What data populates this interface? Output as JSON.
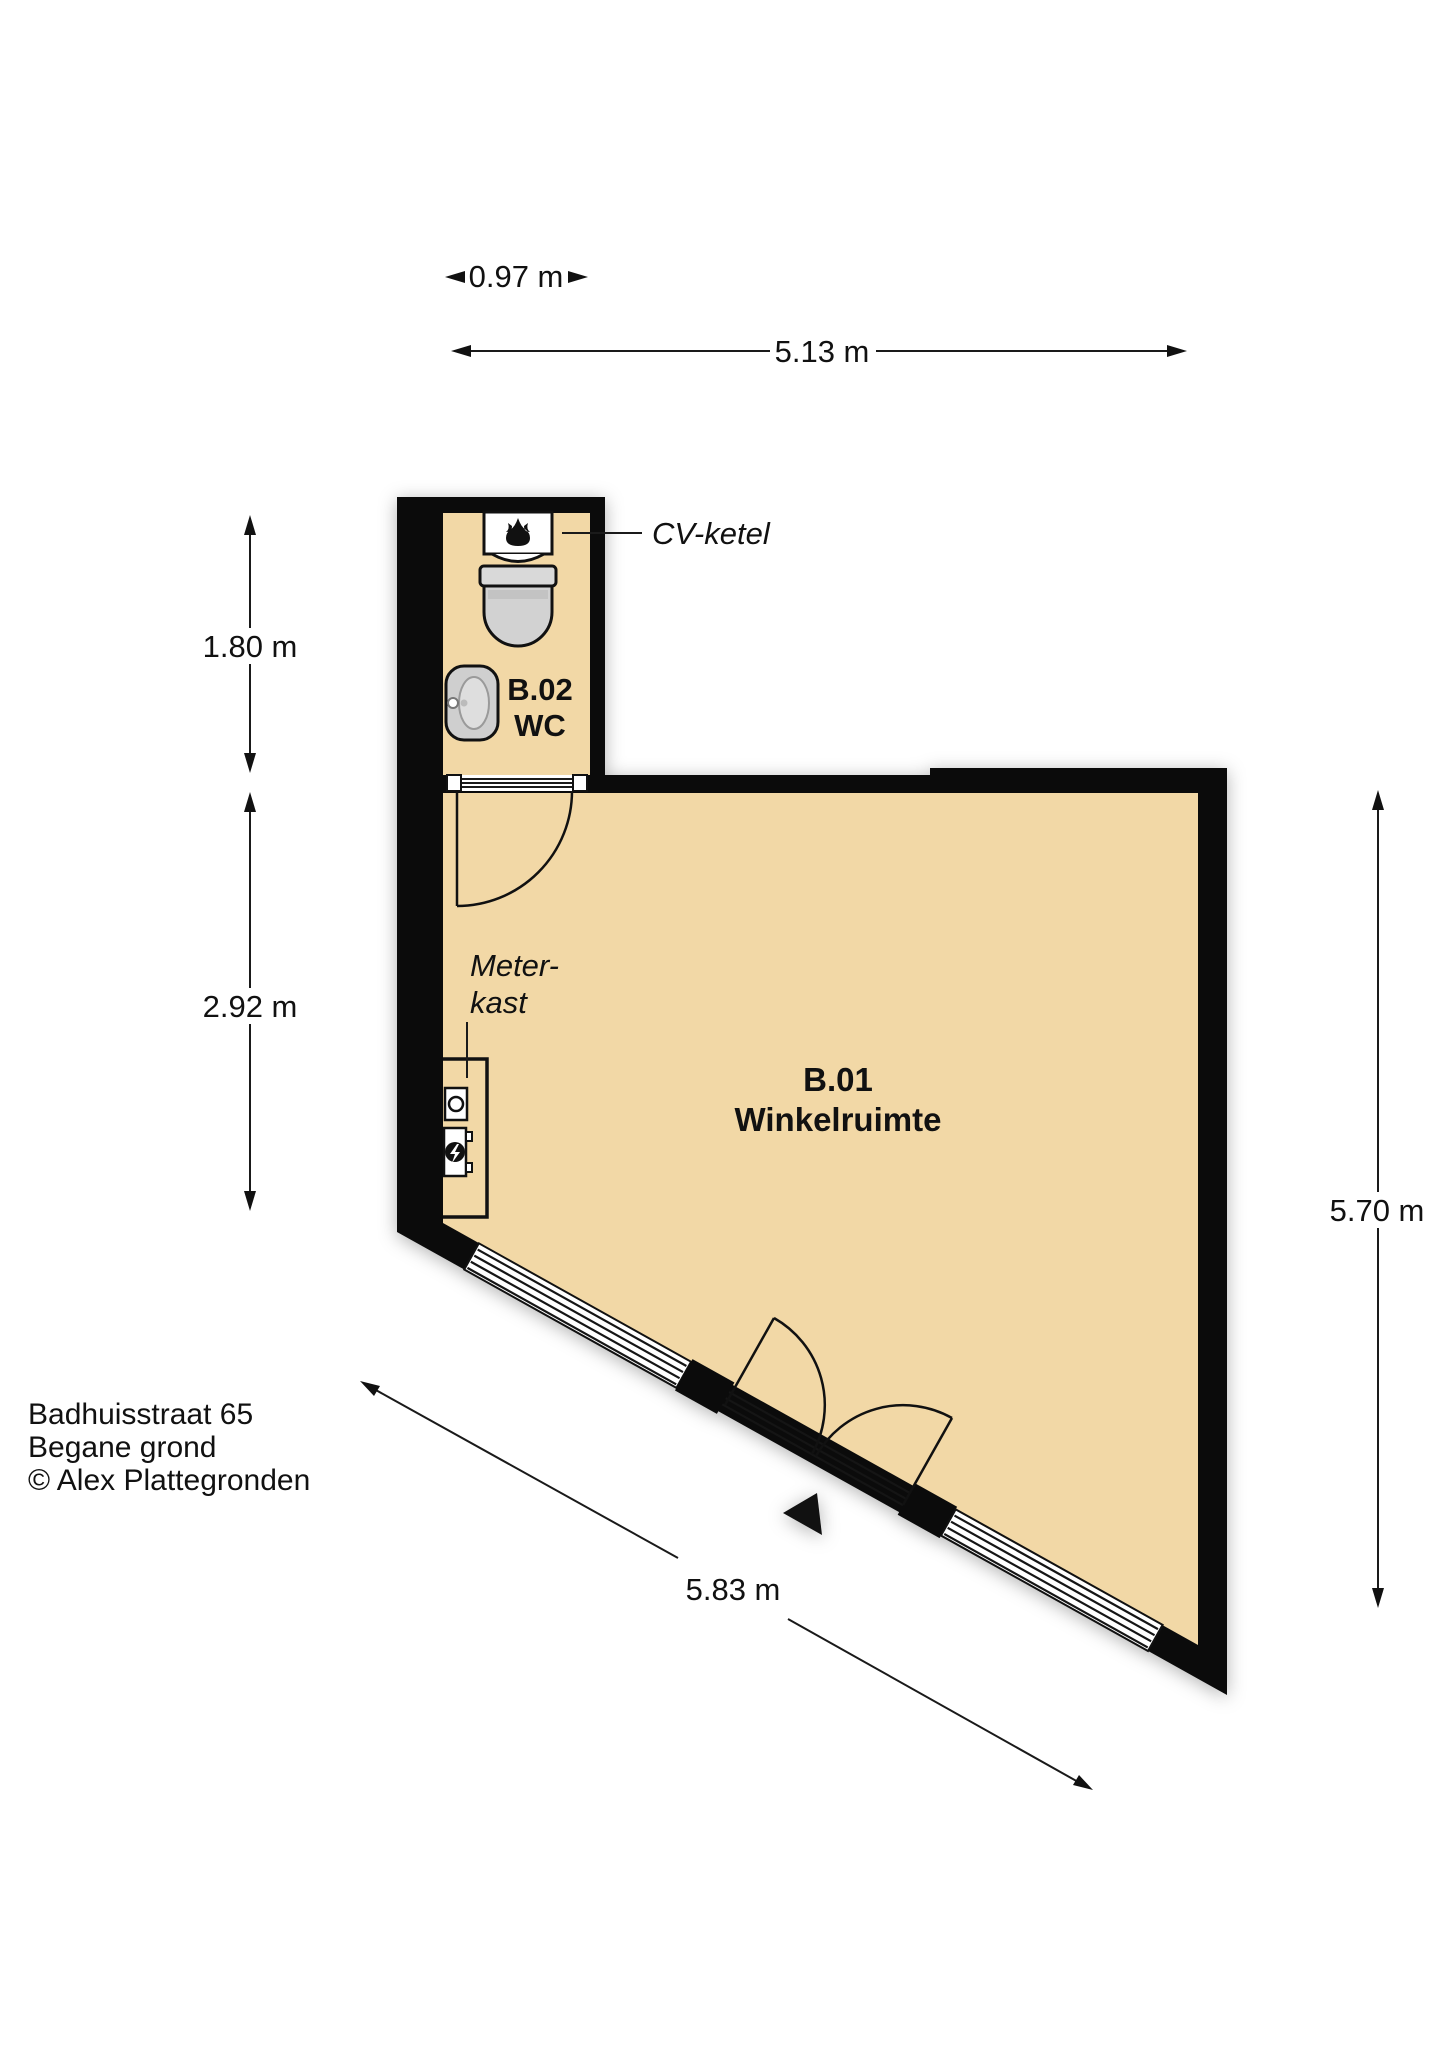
{
  "floor_plan": {
    "rooms": {
      "winkelruimte": {
        "code": "B.01",
        "name": "Winkelruimte"
      },
      "wc": {
        "code": "B.02",
        "name": "WC"
      }
    },
    "labels": {
      "cv_ketel": "CV-ketel",
      "meterkast_line1": "Meter-",
      "meterkast_line2": "kast"
    },
    "dimensions": {
      "wc_width": "0.97 m",
      "building_width": "5.13 m",
      "wc_depth": "1.80 m",
      "shop_left_depth": "2.92 m",
      "right_depth": "5.70 m",
      "storefront_width": "5.83 m"
    },
    "footer": {
      "address": "Badhuisstraat 65",
      "floor": "Begane grond",
      "credit": "© Alex Plattegronden"
    },
    "colors": {
      "floor": "#f2d8a6",
      "wall": "#0b0b0b",
      "fixture": "#d2d2d2",
      "background": "#ffffff"
    }
  }
}
